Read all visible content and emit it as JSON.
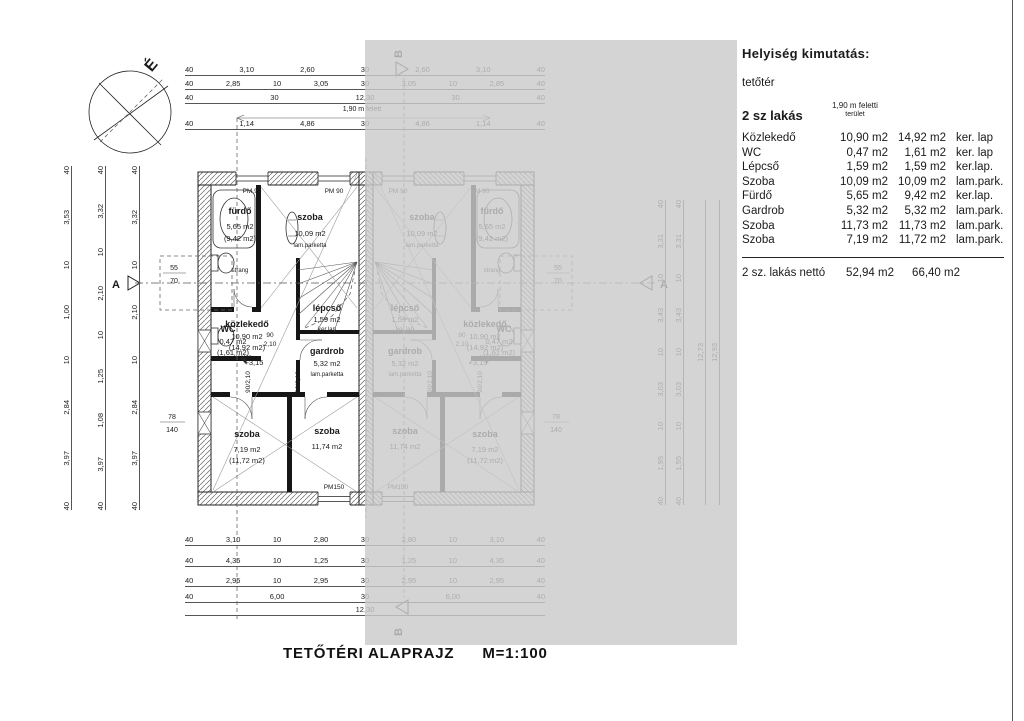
{
  "title": {
    "main": "TETŐTÉRI ALAPRAJZ",
    "scale": "M=1:100"
  },
  "schedule": {
    "heading": "Helyiség kimutatás:",
    "floor": "tetőtér",
    "unit_label": "2 sz lakás",
    "col_header_1": "1,90 m feletti",
    "col_header_2": "terület",
    "rooms": [
      {
        "name": "Közlekedő",
        "above": "10,90 m2",
        "total": "14,92 m2",
        "finish": "ker. lap"
      },
      {
        "name": "WC",
        "above": "0,47 m2",
        "total": "1,61 m2",
        "finish": "ker. lap"
      },
      {
        "name": "Lépcső",
        "above": "1,59 m2",
        "total": "1,59 m2",
        "finish": "ker.lap."
      },
      {
        "name": "Szoba",
        "above": "10,09 m2",
        "total": "10,09 m2",
        "finish": "lam.park."
      },
      {
        "name": "Fürdő",
        "above": "5,65 m2",
        "total": "9,42 m2",
        "finish": "ker.lap."
      },
      {
        "name": "Gardrob",
        "above": "5,32 m2",
        "total": "5,32 m2",
        "finish": "lam.park."
      },
      {
        "name": "Szoba",
        "above": "11,73 m2",
        "total": "11,73 m2",
        "finish": "lam.park."
      },
      {
        "name": "Szoba",
        "above": "7,19 m2",
        "total": "11,72 m2",
        "finish": "lam.park."
      }
    ],
    "total": {
      "label": "2 sz. lakás nettó",
      "above": "52,94 m2",
      "total": "66,40 m2"
    }
  },
  "plan": {
    "north": "É",
    "a": "A",
    "b": "B",
    "level": "+3,15",
    "headroom": "1,90 m felett",
    "strang": "strang",
    "tags": {
      "pm90": "PM 90",
      "pm150": "PM150",
      "door": "90/2,10",
      "door_w": "90",
      "door_h": "2,10"
    },
    "sills": {
      "s55": "55",
      "s70": "70",
      "s78": "78",
      "s140": "140"
    },
    "rooms": {
      "fur": {
        "n": "fürdő",
        "a1": "5,65 m2",
        "a2": "(9,42 m2)"
      },
      "sz1": {
        "n": "szoba",
        "a1": "10,09 m2",
        "f": "lam.parketta"
      },
      "wc": {
        "n": "WC",
        "a1": "0,47 m2",
        "a2": "(1,61 m2)"
      },
      "lep": {
        "n": "lépcső",
        "a1": "1,59 m2",
        "f": "ker.lap"
      },
      "koz": {
        "n": "közlekedő",
        "a1": "10,90 m2",
        "a2": "(14,92 m2)",
        "f": "ker.lap"
      },
      "gar": {
        "n": "gardrob",
        "a1": "5,32 m2",
        "f": "lam.parketta"
      },
      "sz2": {
        "n": "szoba",
        "a1": "7,19 m2",
        "a2": "(11,72 m2)"
      },
      "sz3": {
        "n": "szoba",
        "a1": "11,74 m2"
      }
    }
  },
  "dims": {
    "top_r1": [
      "40",
      "3,10",
      "2,60",
      "30",
      "2,60",
      "3,10",
      "40"
    ],
    "top_r2": [
      "40",
      "2,85",
      "10",
      "3,05",
      "30",
      "3,05",
      "10",
      "2,85",
      "40"
    ],
    "top_r3": [
      "40",
      "30",
      "12,30",
      "30",
      "40"
    ],
    "top_r4": [
      "40",
      "1,14",
      "4,86",
      "30",
      "4,86",
      "1,14",
      "40"
    ],
    "bot_r1": [
      "40",
      "3,10",
      "10",
      "2,80",
      "30",
      "2,80",
      "10",
      "3,10",
      "40"
    ],
    "bot_r2": [
      "40",
      "4,35",
      "10",
      "1,25",
      "30",
      "1,25",
      "10",
      "4,35",
      "40"
    ],
    "bot_r3": [
      "40",
      "2,95",
      "10",
      "2,95",
      "30",
      "2,95",
      "10",
      "2,95",
      "40"
    ],
    "bot_r4": [
      "40",
      "6,00",
      "30",
      "6,00",
      "40"
    ],
    "bot_total": [
      "12,30"
    ],
    "left_c1": [
      "40",
      "3,53",
      "10",
      "1,00",
      "10",
      "2,84",
      "3,97",
      "40"
    ],
    "left_c2": [
      "40",
      "3,32",
      "10",
      "2,10",
      "10",
      "1,25",
      "1,08",
      "3,97",
      "40"
    ],
    "left_c3": [
      "40",
      "3,32",
      "10",
      "2,10",
      "10",
      "2,84",
      "3,97",
      "40"
    ],
    "right_c1": [
      "40",
      "3,31",
      "10",
      "3,43",
      "10",
      "3,03",
      "10",
      "1,95",
      "40"
    ],
    "right_c2": [
      "40",
      "3,31",
      "10",
      "3,43",
      "10",
      "3,03",
      "10",
      "1,95",
      "40"
    ],
    "right_t1": [
      "12,73"
    ],
    "right_t2": [
      "12,93"
    ]
  }
}
